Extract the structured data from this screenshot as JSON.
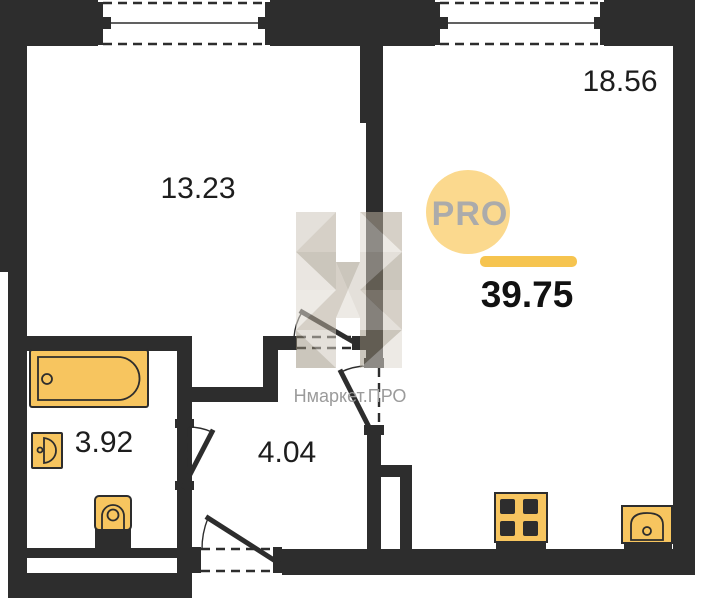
{
  "floorplan": {
    "rooms": [
      {
        "id": "room-13-23",
        "area_label": "13.23"
      },
      {
        "id": "room-18-56",
        "area_label": "18.56"
      },
      {
        "id": "bathroom",
        "area_label": "3.92"
      },
      {
        "id": "hallway",
        "area_label": "4.04"
      }
    ],
    "total_area": "39.75",
    "watermark": {
      "logo_text": "PRO",
      "brand_text": "Нмаркет.ПРО"
    },
    "fixtures": [
      "bathtub",
      "bathroom-sink",
      "toilet",
      "stove",
      "kitchen-sink"
    ],
    "colors": {
      "wall": "#2d2d2d",
      "fixture_fill": "#F7C55F",
      "logo_circle": "#FBD98E",
      "accent_underline": "#F6C44F",
      "logo_text": "#ABABAB",
      "watermark_text": "#9B9B9B",
      "label_text": "#1d1d1d"
    }
  }
}
